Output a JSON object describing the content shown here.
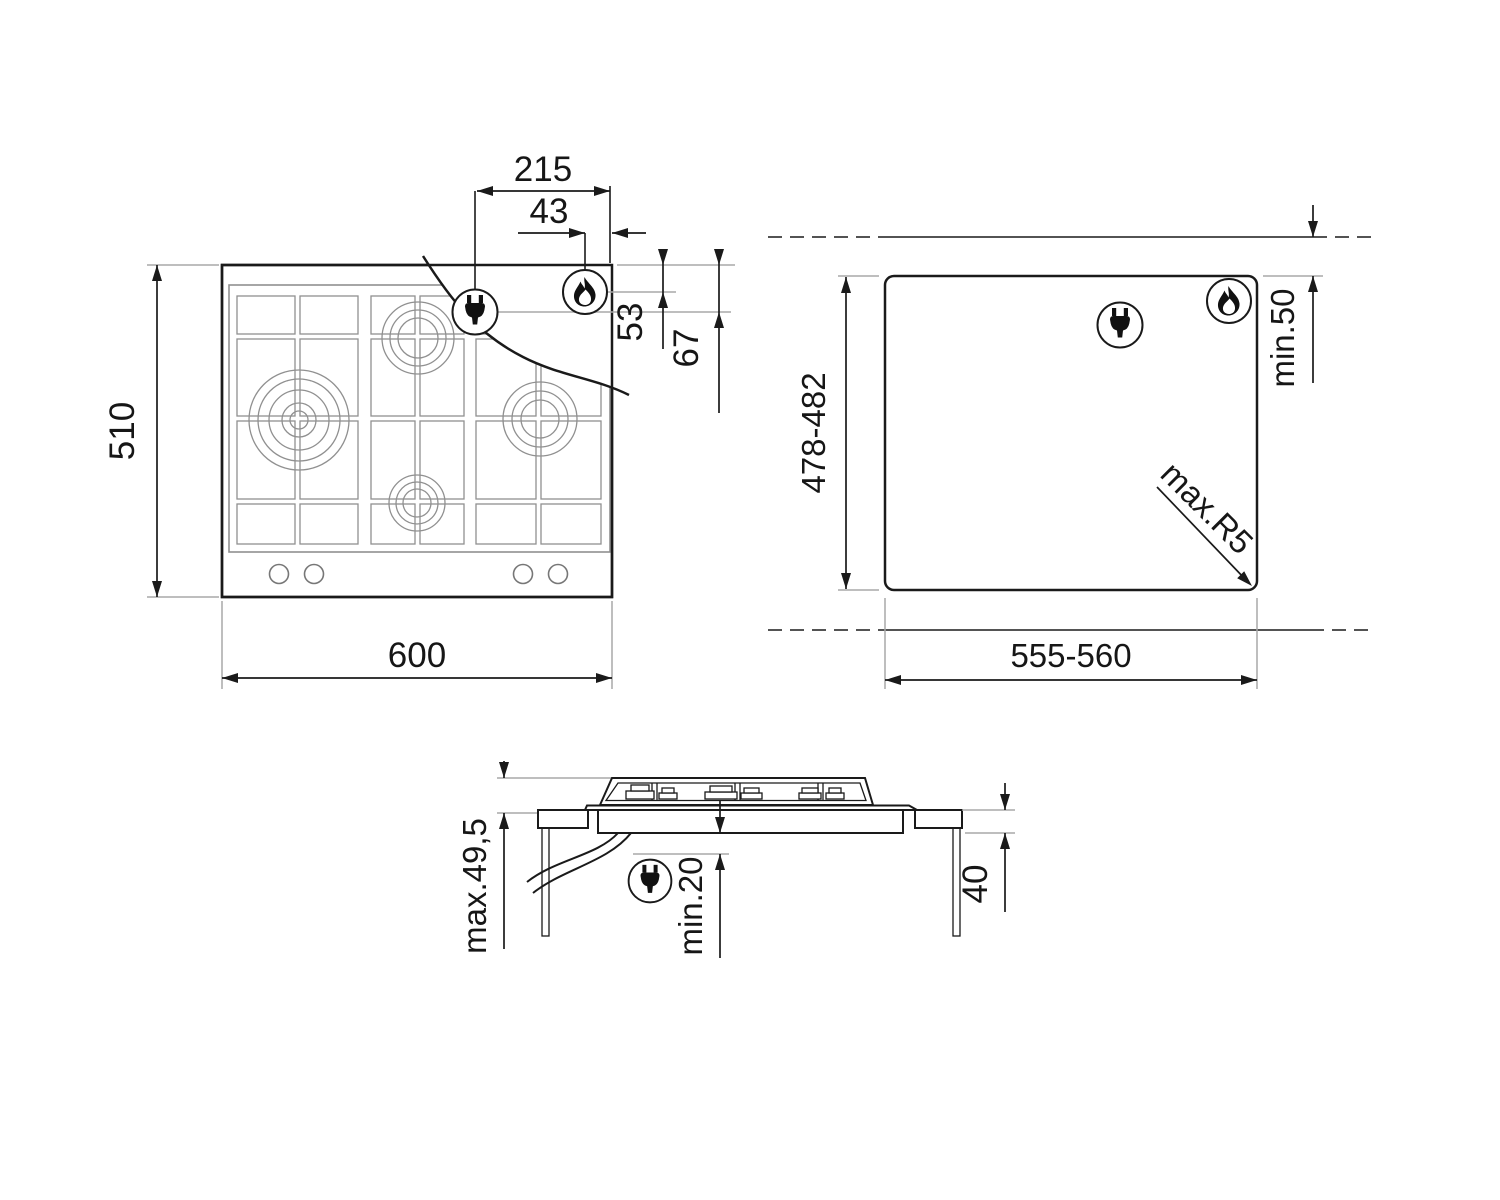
{
  "drawing": {
    "type": "gas-hob-installation-diagram",
    "colors": {
      "line": "#1a1a1a",
      "grid_gray": "#909090",
      "extension_gray": "#a8a8a8",
      "background": "#ffffff"
    },
    "top_view": {
      "width_label": "600",
      "height_label": "510",
      "plug_offset_from_right_label": "215",
      "flame_offset_from_right_label": "43",
      "flame_offset_from_top_label": "53",
      "plug_offset_from_top_label": "67"
    },
    "cutout_view": {
      "width_label": "555-560",
      "height_label": "478-482",
      "rear_clearance_label": "min.50",
      "corner_radius_label": "max.R5"
    },
    "side_view": {
      "overall_height_label": "max.49,5",
      "clearance_below_label": "min.20",
      "worktop_thickness_label": "40"
    },
    "icons": {
      "plug": "power-plug",
      "flame": "gas-flame"
    }
  }
}
